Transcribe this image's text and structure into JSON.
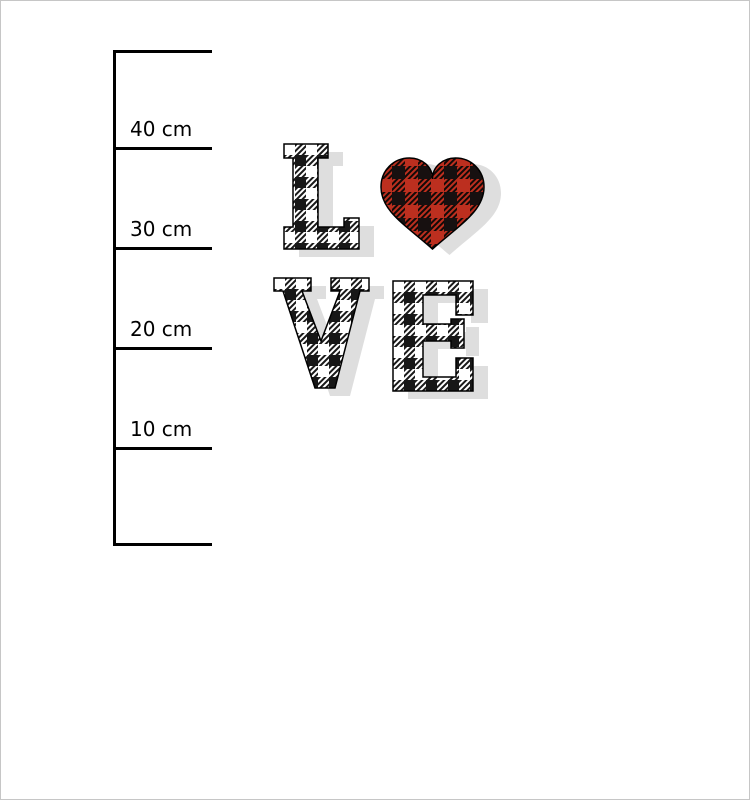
{
  "window": {
    "background": "#ffffff",
    "frame_border": "#c6c6c6"
  },
  "ruler": {
    "line_color": "#000000",
    "marks": [
      {
        "label": "40 cm"
      },
      {
        "label": "30 cm"
      },
      {
        "label": "20 cm"
      },
      {
        "label": "10 cm"
      }
    ]
  },
  "design": {
    "word": "LOVE",
    "letter_l": "L",
    "letter_v": "V",
    "letter_e": "E",
    "heart": "buffalo-plaid-heart",
    "colors": {
      "plaid_red": "#bc2f1f",
      "plaid_red_dark": "#5f1510",
      "plaid_black": "#171010",
      "bw_black": "#171717",
      "bw_white": "#ffffff",
      "hatch_dark": "#1a1a1a",
      "shadow": "#dedede",
      "outline": "#000000"
    }
  }
}
